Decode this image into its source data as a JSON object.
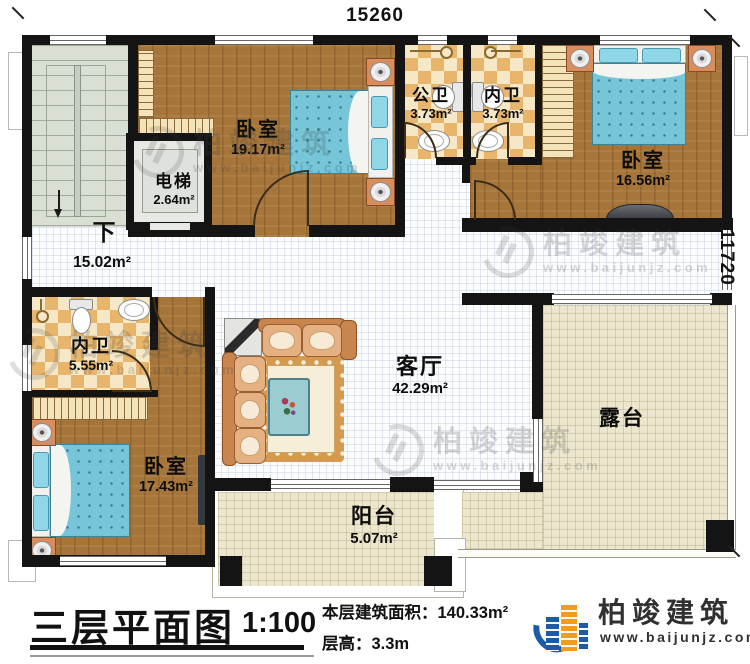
{
  "dimensions": {
    "top": "15260",
    "right": "11720"
  },
  "stairs": {
    "down_label": "下"
  },
  "rooms": [
    {
      "id": "bedroom-top-middle",
      "label": "卧室",
      "area": "19.17m²"
    },
    {
      "id": "elevator",
      "label": "电梯",
      "area": "2.64m²"
    },
    {
      "id": "public-bathroom",
      "label": "公卫",
      "area": "3.73m²"
    },
    {
      "id": "ensuite-bathroom-top",
      "label": "内卫",
      "area": "3.73m²"
    },
    {
      "id": "bedroom-top-right",
      "label": "卧室",
      "area": "16.56m²"
    },
    {
      "id": "hallway",
      "label": "",
      "area": "15.02m²"
    },
    {
      "id": "ensuite-bathroom-left",
      "label": "内卫",
      "area": "5.55m²"
    },
    {
      "id": "bedroom-bottom-left",
      "label": "卧室",
      "area": "17.43m²"
    },
    {
      "id": "living-room",
      "label": "客厅",
      "area": "42.29m²"
    },
    {
      "id": "balcony",
      "label": "阳台",
      "area": "5.07m²"
    },
    {
      "id": "terrace",
      "label": "露台",
      "area": ""
    }
  ],
  "titleblock": {
    "title": "三层平面图",
    "scale": "1:100",
    "area_line": "本层建筑面积：140.33m²",
    "height_line": "层高：3.3m"
  },
  "brand": {
    "name": "柏竣建筑",
    "website": "www.baijunjz.com"
  },
  "watermark": {
    "name": "柏竣建筑",
    "website": "www.baijunjz.com"
  },
  "colors": {
    "wall": "#141414",
    "wood_floor": "#a6753a",
    "tile_light": "#f6e8c6",
    "tile_dark": "#e7b56c",
    "bed_blue": "#76c5d8",
    "terrace_floor": "#ebe6cd",
    "stair_floor": "#d9dfd3",
    "sofa_tan": "#c9854e",
    "brand_blue": "#1d5ba6",
    "brand_orange": "#f29b1d"
  }
}
